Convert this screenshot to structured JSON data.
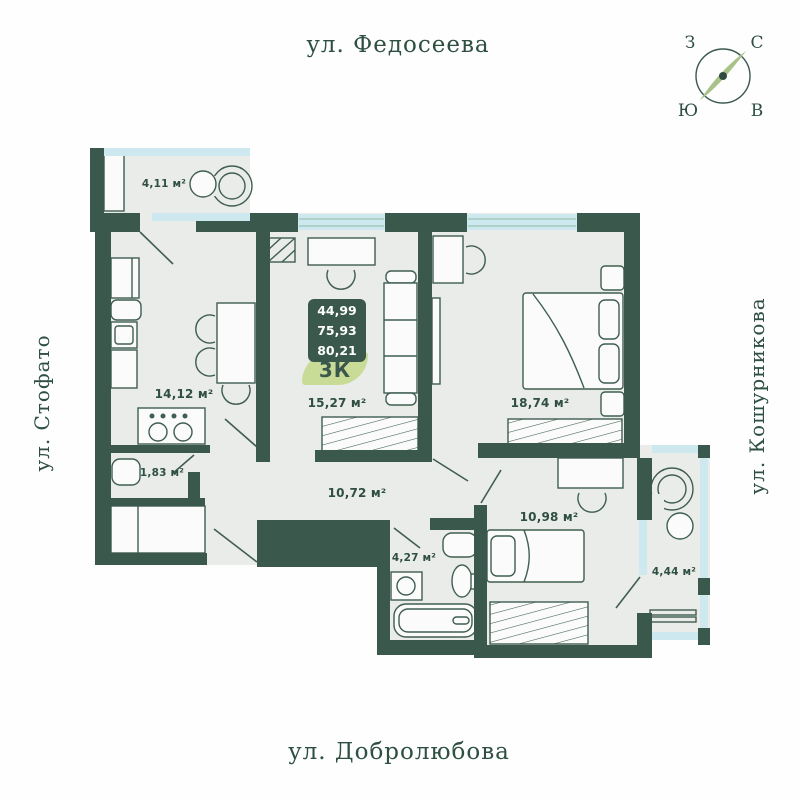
{
  "streets": {
    "top": "ул. Федосеева",
    "bottom": "ул. Добролюбова",
    "left": "ул. Стофато",
    "right": "ул. Кошурникова"
  },
  "compass": {
    "west": "З",
    "north": "С",
    "south": "Ю",
    "east": "В"
  },
  "info_card": {
    "areas": [
      "44,99",
      "75,93",
      "80,21"
    ],
    "badge": "3К"
  },
  "rooms": [
    {
      "id": "balcony-top",
      "area": "4,11 м²"
    },
    {
      "id": "kitchen",
      "area": "14,12 м²"
    },
    {
      "id": "storage",
      "area": "1,83 м²"
    },
    {
      "id": "living",
      "area": "15,27 м²"
    },
    {
      "id": "bedroom",
      "area": "18,74 м²"
    },
    {
      "id": "hallway",
      "area": "10,72 м²"
    },
    {
      "id": "bathroom",
      "area": "4,27 м²"
    },
    {
      "id": "child-room",
      "area": "10,98 м²"
    },
    {
      "id": "balcony-right",
      "area": "4,44 м²"
    }
  ],
  "colors": {
    "wall": "#3b584c",
    "floor": "#eaece9",
    "glass": "#cde8ee",
    "leaf_badge": "#c8db97",
    "text": "#2e4f41",
    "compass_needle": "#a9c289"
  }
}
